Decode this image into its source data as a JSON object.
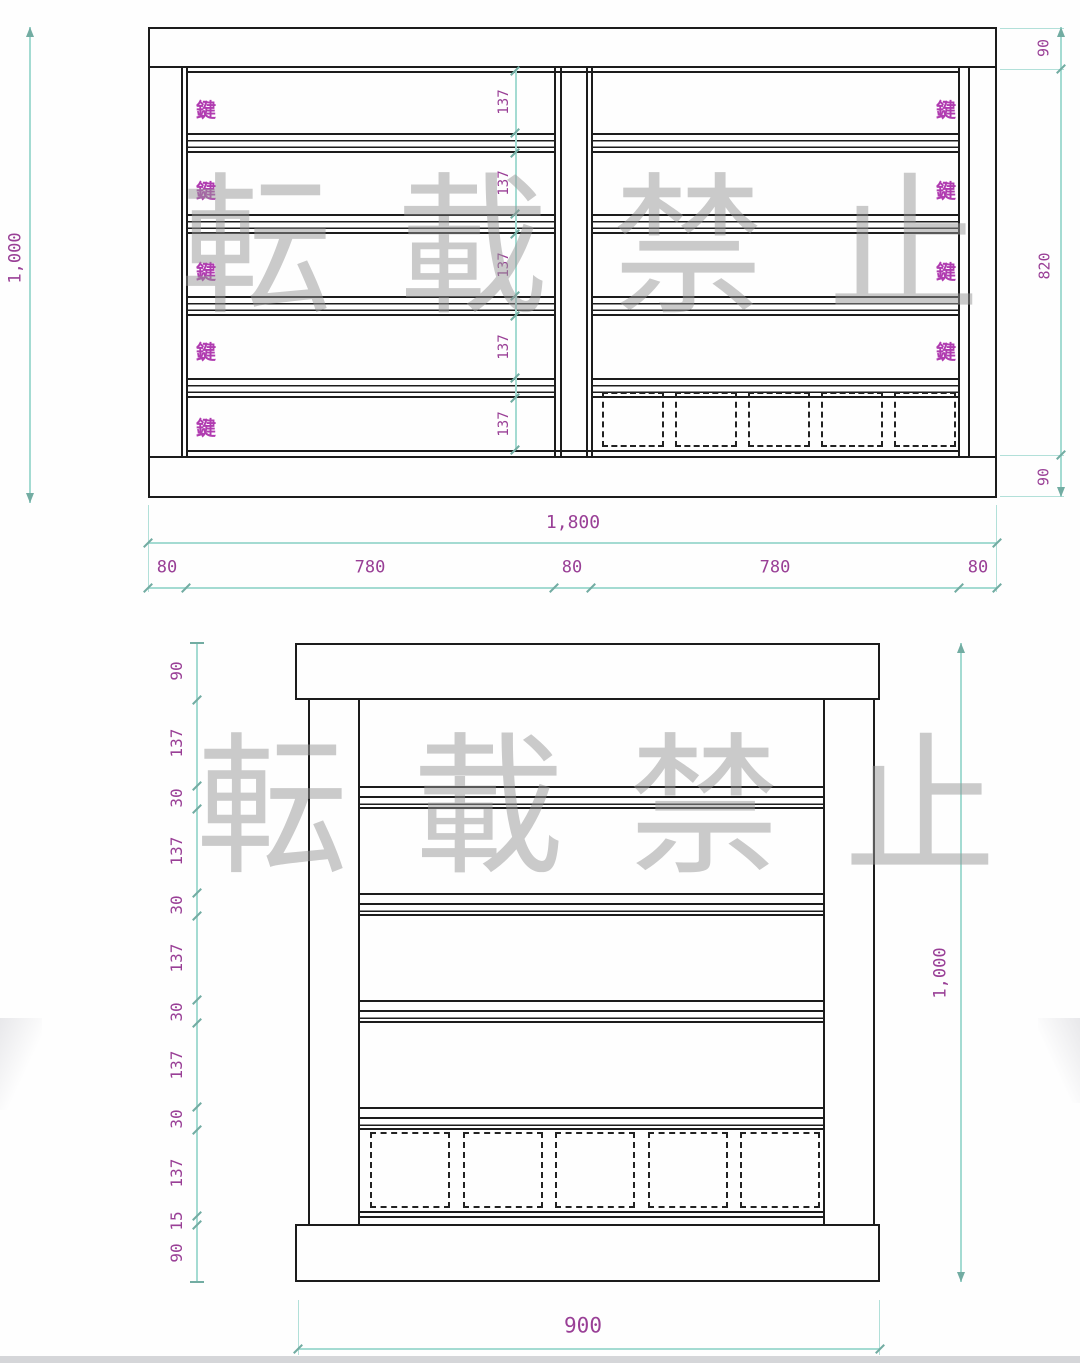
{
  "watermark": {
    "text": "転載禁止"
  },
  "top_drawing": {
    "keys_left": [
      "鍵",
      "鍵",
      "鍵",
      "鍵",
      "鍵"
    ],
    "keys_right": [
      "鍵",
      "鍵",
      "鍵",
      "鍵"
    ],
    "shelf_openings": [
      "137",
      "137",
      "137",
      "137",
      "137"
    ],
    "height_total": "1,000",
    "right_chain": [
      "90",
      "820",
      "90"
    ],
    "width_total": "1,800",
    "width_segments": [
      "80",
      "780",
      "80",
      "780",
      "80"
    ]
  },
  "bottom_drawing": {
    "left_chain": [
      "90",
      "137",
      "30",
      "137",
      "30",
      "137",
      "30",
      "137",
      "30",
      "137",
      "15",
      "90"
    ],
    "height_total": "1,000",
    "width_total": "900"
  },
  "colors": {
    "line": "#1c1c1c",
    "dim_line": "#a4dbd2",
    "dim_tick": "#72aca2",
    "dim_text": "#993f96",
    "key_text": "#b03cb0",
    "watermark": "#c2c2c2"
  }
}
